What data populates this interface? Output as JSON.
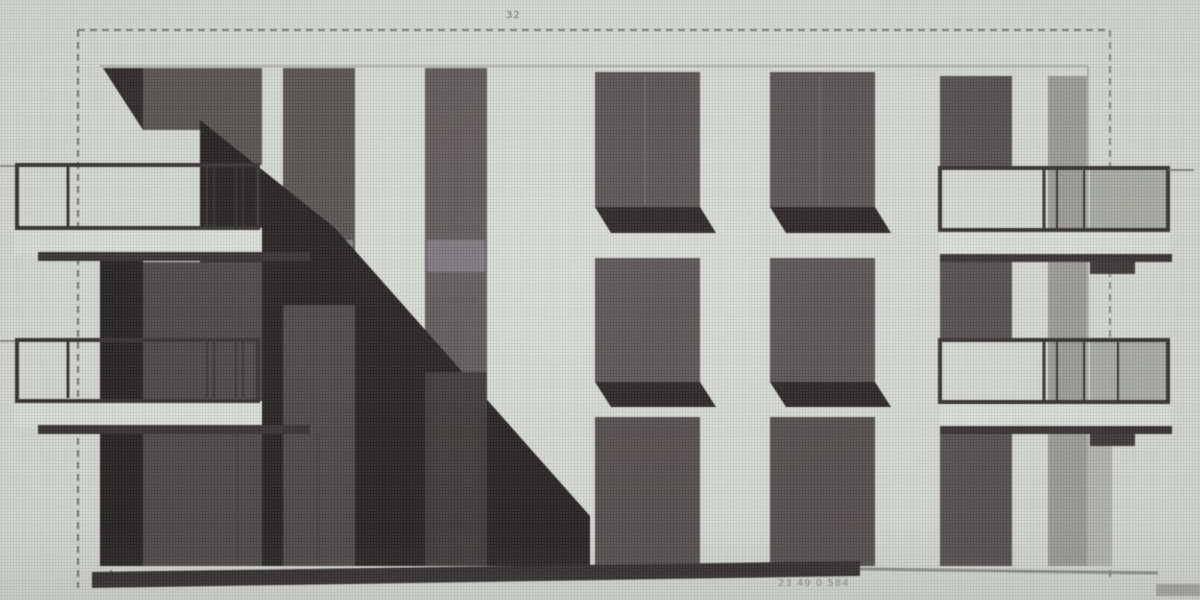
{
  "meta": {
    "description": "Scanned architectural elevation drawing of a three-storey building with dark window strips, left and right projecting balconies with railings, a large diagonal cast shadow across the lower-left facade, a dashed drawing border and faint dimension annotations."
  },
  "canvas": {
    "width": 1200,
    "height": 600,
    "background": "#d8dbd5"
  },
  "palette": {
    "paper": "#d8dbd5",
    "window_dark": "#55504f",
    "window_mid": "#5d5758",
    "shadow_black": "#211d1e",
    "shadow_band": "#4a4445",
    "spandrel_blue": "#7e838a",
    "slab_light": "#dde1da",
    "rail_dark": "#332e2f",
    "grey_strip": "#9b9c98",
    "ground_dark": "#2c2829",
    "frame_dash": "#5a5f5a"
  },
  "annotations": {
    "top_dimension": "32",
    "bottom_dimension": "23 49 0 584"
  },
  "shapes": [
    {
      "name": "frame-border-top",
      "kind": "line",
      "x1": 78,
      "y1": 30,
      "x2": 1110,
      "y2": 30,
      "stroke": "#5a5f5a",
      "sw": 2,
      "dash": "7 5",
      "op": 0.85
    },
    {
      "name": "frame-border-left",
      "kind": "line",
      "x1": 78,
      "y1": 30,
      "x2": 78,
      "y2": 588,
      "stroke": "#5a5f5a",
      "sw": 2,
      "dash": "7 5",
      "op": 0.85
    },
    {
      "name": "frame-border-right",
      "kind": "line",
      "x1": 1110,
      "y1": 30,
      "x2": 1110,
      "y2": 582,
      "stroke": "#5a5f5a",
      "sw": 2,
      "dash": "7 5",
      "op": 0.7
    },
    {
      "name": "frame-tick-left-lower",
      "kind": "line",
      "x1": 111,
      "y1": 522,
      "x2": 111,
      "y2": 586,
      "stroke": "#565b56",
      "sw": 2,
      "dash": "4 4",
      "op": 0.8
    },
    {
      "name": "roof-edge-line",
      "kind": "line",
      "x1": 100,
      "y1": 66,
      "x2": 1088,
      "y2": 66,
      "stroke": "#a6a9a2",
      "sw": 2,
      "op": 0.9
    },
    {
      "name": "corner-shadow-triangle",
      "kind": "poly",
      "points": "103,68 143,68 143,130",
      "fill": "#2a2526"
    },
    {
      "name": "window-strip-1-upper",
      "kind": "rect",
      "x": 143,
      "y": 68,
      "w": 119,
      "h": 62,
      "fill": "#55504f"
    },
    {
      "name": "window-strip-1-upper-right",
      "kind": "rect",
      "x": 200,
      "y": 68,
      "w": 62,
      "h": 97,
      "fill": "#55504f"
    },
    {
      "name": "window-strip-2",
      "kind": "rect",
      "x": 283,
      "y": 68,
      "w": 72,
      "h": 498,
      "fill": "#55504f"
    },
    {
      "name": "window-strip-3",
      "kind": "rect",
      "x": 425,
      "y": 68,
      "w": 62,
      "h": 498,
      "fill": "#5d5758"
    },
    {
      "name": "window-4-upper",
      "kind": "rect",
      "x": 595,
      "y": 72,
      "w": 105,
      "h": 135,
      "fill": "#565051"
    },
    {
      "name": "window-4-upper-mullion",
      "kind": "line",
      "x1": 645,
      "y1": 76,
      "x2": 645,
      "y2": 205,
      "stroke": "#6e686a",
      "sw": 2,
      "op": 0.7
    },
    {
      "name": "window-5-upper",
      "kind": "rect",
      "x": 770,
      "y": 72,
      "w": 105,
      "h": 135,
      "fill": "#565051"
    },
    {
      "name": "window-5-upper-mullion",
      "kind": "line",
      "x1": 820,
      "y1": 76,
      "x2": 820,
      "y2": 205,
      "stroke": "#6e686a",
      "sw": 2,
      "op": 0.7
    },
    {
      "name": "window-4-upper-sill-shadow",
      "kind": "poly",
      "points": "595,207 700,207 716,233 611,233",
      "fill": "#262122"
    },
    {
      "name": "window-5-upper-sill-shadow",
      "kind": "poly",
      "points": "770,207 875,207 891,233 786,233",
      "fill": "#262122"
    },
    {
      "name": "window-strip-6-upper",
      "kind": "rect",
      "x": 940,
      "y": 76,
      "w": 72,
      "h": 92,
      "fill": "#514c4d"
    },
    {
      "name": "grey-strip-7",
      "kind": "rect",
      "x": 1048,
      "y": 76,
      "w": 39,
      "h": 490,
      "fill": "#9b9c98"
    },
    {
      "name": "building-right-edge",
      "kind": "line",
      "x1": 1088,
      "y1": 66,
      "x2": 1088,
      "y2": 565,
      "stroke": "#a0a39d",
      "sw": 1.5,
      "op": 0.8
    },
    {
      "name": "spandrel-panel-strip-2",
      "kind": "rect",
      "x": 285,
      "y": 240,
      "w": 68,
      "h": 32,
      "fill": "#7e838a"
    },
    {
      "name": "spandrel-panel-strip-3",
      "kind": "rect",
      "x": 427,
      "y": 240,
      "w": 58,
      "h": 32,
      "fill": "#7a767a"
    },
    {
      "name": "main-diagonal-shadow",
      "kind": "poly",
      "points": "200,120 335,228 590,516 590,566 143,566 143,262 200,262",
      "fill": "#211d1e"
    },
    {
      "name": "left-lower-shadow",
      "kind": "rect",
      "x": 100,
      "y": 258,
      "w": 43,
      "h": 308,
      "fill": "#211d1e"
    },
    {
      "name": "shadowed-window-band-1",
      "kind": "rect",
      "x": 143,
      "y": 262,
      "w": 119,
      "h": 304,
      "fill": "#4a4445"
    },
    {
      "name": "shadowed-window-band-2",
      "kind": "rect",
      "x": 283,
      "y": 305,
      "w": 72,
      "h": 261,
      "fill": "#4a4445"
    },
    {
      "name": "shadowed-window-band-3",
      "kind": "rect",
      "x": 425,
      "y": 372,
      "w": 62,
      "h": 194,
      "fill": "#3a3536"
    },
    {
      "name": "window-4-middle",
      "kind": "rect",
      "x": 595,
      "y": 258,
      "w": 105,
      "h": 124,
      "fill": "#565051"
    },
    {
      "name": "window-5-middle",
      "kind": "rect",
      "x": 770,
      "y": 258,
      "w": 105,
      "h": 124,
      "fill": "#565051"
    },
    {
      "name": "window-4-middle-sill-shadow",
      "kind": "poly",
      "points": "595,382 700,382 716,407 611,407",
      "fill": "#262122"
    },
    {
      "name": "window-5-middle-sill-shadow",
      "kind": "poly",
      "points": "770,382 875,382 891,407 786,407",
      "fill": "#262122"
    },
    {
      "name": "window-4-lower",
      "kind": "rect",
      "x": 595,
      "y": 417,
      "w": 105,
      "h": 149,
      "fill": "#504a4b"
    },
    {
      "name": "window-5-lower",
      "kind": "rect",
      "x": 770,
      "y": 417,
      "w": 105,
      "h": 149,
      "fill": "#504a4b"
    },
    {
      "name": "window-strip-6-middle",
      "kind": "rect",
      "x": 940,
      "y": 262,
      "w": 72,
      "h": 78,
      "fill": "#514c4d"
    },
    {
      "name": "window-strip-6-lower",
      "kind": "rect",
      "x": 940,
      "y": 430,
      "w": 72,
      "h": 136,
      "fill": "#514c4d"
    },
    {
      "name": "grey-strip-7-lower-wide",
      "kind": "rect",
      "x": 1087,
      "y": 430,
      "w": 25,
      "h": 136,
      "fill": "#b4b6b1"
    },
    {
      "name": "balcony-b-support-post-1",
      "kind": "line",
      "x1": 237,
      "y1": 433,
      "x2": 237,
      "y2": 564,
      "stroke": "#3e3a3b",
      "sw": 2
    },
    {
      "name": "balcony-b-support-post-2",
      "kind": "line",
      "x1": 318,
      "y1": 433,
      "x2": 318,
      "y2": 564,
      "stroke": "#3e3a3b",
      "sw": 2
    },
    {
      "name": "ground-line-heavy",
      "kind": "poly",
      "points": "92,572 860,561 860,576 92,588",
      "fill": "#2c2829"
    },
    {
      "name": "ground-line-thin-right",
      "kind": "line",
      "x1": 860,
      "y1": 569,
      "x2": 1158,
      "y2": 573,
      "stroke": "#85887f",
      "sw": 3,
      "op": 0.9
    },
    {
      "name": "balcony-c-side-wall",
      "kind": "rect",
      "x": 1090,
      "y": 168,
      "w": 78,
      "h": 62,
      "fill": "#a9aba5"
    },
    {
      "name": "balcony-d-side-wall",
      "kind": "rect",
      "x": 1090,
      "y": 340,
      "w": 78,
      "h": 62,
      "fill": "#a9aba5"
    },
    {
      "name": "balcony-a-left-tick",
      "kind": "line",
      "x1": 0,
      "y1": 166,
      "x2": 17,
      "y2": 166,
      "stroke": "#5a5656",
      "sw": 2,
      "op": 0.6
    },
    {
      "name": "balcony-b-left-tick",
      "kind": "line",
      "x1": 0,
      "y1": 341,
      "x2": 17,
      "y2": 341,
      "stroke": "#5a5656",
      "sw": 2,
      "op": 0.6
    },
    {
      "name": "balcony-a-slab",
      "kind": "rect",
      "x": 15,
      "y": 226,
      "w": 247,
      "h": 28,
      "fill": "#dde1da"
    },
    {
      "name": "balcony-a-slab-top-line",
      "kind": "line",
      "x1": 15,
      "y1": 227,
      "x2": 262,
      "y2": 227,
      "stroke": "#3a3536",
      "sw": 2
    },
    {
      "name": "balcony-a-slab-edge",
      "kind": "rect",
      "x": 38,
      "y": 252,
      "w": 272,
      "h": 9,
      "fill": "#332e2f"
    },
    {
      "name": "balcony-a-railing",
      "kind": "rect",
      "x": 17,
      "y": 165,
      "w": 241,
      "h": 63,
      "fill": "none",
      "stroke": "#332e2f",
      "sw": 4
    },
    {
      "name": "balcony-a-post-1",
      "kind": "line",
      "x1": 68,
      "y1": 167,
      "x2": 68,
      "y2": 226,
      "stroke": "#332e2f",
      "sw": 3
    },
    {
      "name": "balcony-a-post-2",
      "kind": "line",
      "x1": 207,
      "y1": 167,
      "x2": 207,
      "y2": 226,
      "stroke": "#332e2f",
      "sw": 2
    },
    {
      "name": "balcony-a-post-3",
      "kind": "line",
      "x1": 214,
      "y1": 167,
      "x2": 214,
      "y2": 226,
      "stroke": "#332e2f",
      "sw": 2
    },
    {
      "name": "balcony-a-post-4",
      "kind": "line",
      "x1": 236,
      "y1": 167,
      "x2": 236,
      "y2": 226,
      "stroke": "#332e2f",
      "sw": 2
    },
    {
      "name": "balcony-a-post-5",
      "kind": "line",
      "x1": 243,
      "y1": 167,
      "x2": 243,
      "y2": 226,
      "stroke": "#332e2f",
      "sw": 2
    },
    {
      "name": "balcony-b-slab",
      "kind": "rect",
      "x": 15,
      "y": 399,
      "w": 247,
      "h": 28,
      "fill": "#dde1da"
    },
    {
      "name": "balcony-b-slab-top-line",
      "kind": "line",
      "x1": 15,
      "y1": 400,
      "x2": 262,
      "y2": 400,
      "stroke": "#3a3536",
      "sw": 2
    },
    {
      "name": "balcony-b-slab-edge",
      "kind": "rect",
      "x": 38,
      "y": 425,
      "w": 272,
      "h": 9,
      "fill": "#332e2f"
    },
    {
      "name": "balcony-b-railing",
      "kind": "rect",
      "x": 17,
      "y": 340,
      "w": 241,
      "h": 61,
      "fill": "none",
      "stroke": "#332e2f",
      "sw": 4
    },
    {
      "name": "balcony-b-post-1",
      "kind": "line",
      "x1": 68,
      "y1": 342,
      "x2": 68,
      "y2": 398,
      "stroke": "#332e2f",
      "sw": 3
    },
    {
      "name": "balcony-b-post-2",
      "kind": "line",
      "x1": 207,
      "y1": 342,
      "x2": 207,
      "y2": 398,
      "stroke": "#332e2f",
      "sw": 2
    },
    {
      "name": "balcony-b-post-3",
      "kind": "line",
      "x1": 214,
      "y1": 342,
      "x2": 214,
      "y2": 398,
      "stroke": "#332e2f",
      "sw": 2
    },
    {
      "name": "balcony-b-post-4",
      "kind": "line",
      "x1": 236,
      "y1": 342,
      "x2": 236,
      "y2": 398,
      "stroke": "#332e2f",
      "sw": 2
    },
    {
      "name": "balcony-b-post-5",
      "kind": "line",
      "x1": 243,
      "y1": 342,
      "x2": 243,
      "y2": 398,
      "stroke": "#332e2f",
      "sw": 2
    },
    {
      "name": "balcony-c-slab",
      "kind": "rect",
      "x": 940,
      "y": 230,
      "w": 230,
      "h": 26,
      "fill": "#dde1da"
    },
    {
      "name": "balcony-c-slab-edge",
      "kind": "rect",
      "x": 940,
      "y": 254,
      "w": 232,
      "h": 8,
      "fill": "#332e2f"
    },
    {
      "name": "balcony-c-under-shadow",
      "kind": "rect",
      "x": 1090,
      "y": 262,
      "w": 45,
      "h": 12,
      "fill": "#3a3536"
    },
    {
      "name": "balcony-c-railing",
      "kind": "rect",
      "x": 940,
      "y": 168,
      "w": 228,
      "h": 62,
      "fill": "none",
      "stroke": "#332e2f",
      "sw": 4
    },
    {
      "name": "balcony-c-post-1",
      "kind": "line",
      "x1": 1044,
      "y1": 170,
      "x2": 1044,
      "y2": 229,
      "stroke": "#332e2f",
      "sw": 3
    },
    {
      "name": "balcony-c-post-2",
      "kind": "line",
      "x1": 1057,
      "y1": 170,
      "x2": 1057,
      "y2": 229,
      "stroke": "#332e2f",
      "sw": 2
    },
    {
      "name": "balcony-c-post-3",
      "kind": "line",
      "x1": 1084,
      "y1": 170,
      "x2": 1084,
      "y2": 229,
      "stroke": "#332e2f",
      "sw": 2
    },
    {
      "name": "balcony-c-right-tick",
      "kind": "line",
      "x1": 1168,
      "y1": 170,
      "x2": 1194,
      "y2": 170,
      "stroke": "#6a6e68",
      "sw": 2,
      "op": 0.8
    },
    {
      "name": "balcony-d-slab",
      "kind": "rect",
      "x": 940,
      "y": 402,
      "w": 230,
      "h": 26,
      "fill": "#dde1da"
    },
    {
      "name": "balcony-d-slab-edge",
      "kind": "rect",
      "x": 940,
      "y": 426,
      "w": 232,
      "h": 8,
      "fill": "#332e2f"
    },
    {
      "name": "balcony-d-under-shadow",
      "kind": "rect",
      "x": 1090,
      "y": 434,
      "w": 45,
      "h": 12,
      "fill": "#3a3536"
    },
    {
      "name": "balcony-d-railing",
      "kind": "rect",
      "x": 940,
      "y": 340,
      "w": 228,
      "h": 62,
      "fill": "none",
      "stroke": "#332e2f",
      "sw": 4
    },
    {
      "name": "balcony-d-post-1",
      "kind": "line",
      "x1": 1044,
      "y1": 342,
      "x2": 1044,
      "y2": 400,
      "stroke": "#332e2f",
      "sw": 3
    },
    {
      "name": "balcony-d-post-2",
      "kind": "line",
      "x1": 1057,
      "y1": 342,
      "x2": 1057,
      "y2": 400,
      "stroke": "#332e2f",
      "sw": 2
    },
    {
      "name": "balcony-d-post-3",
      "kind": "line",
      "x1": 1084,
      "y1": 342,
      "x2": 1084,
      "y2": 400,
      "stroke": "#332e2f",
      "sw": 2
    },
    {
      "name": "balcony-d-post-4",
      "kind": "line",
      "x1": 1118,
      "y1": 342,
      "x2": 1118,
      "y2": 400,
      "stroke": "#332e2f",
      "sw": 2
    },
    {
      "name": "corner-smudge",
      "kind": "rect",
      "x": 1156,
      "y": 584,
      "w": 46,
      "h": 12,
      "fill": "#6e6a66",
      "op": 0.45
    }
  ]
}
